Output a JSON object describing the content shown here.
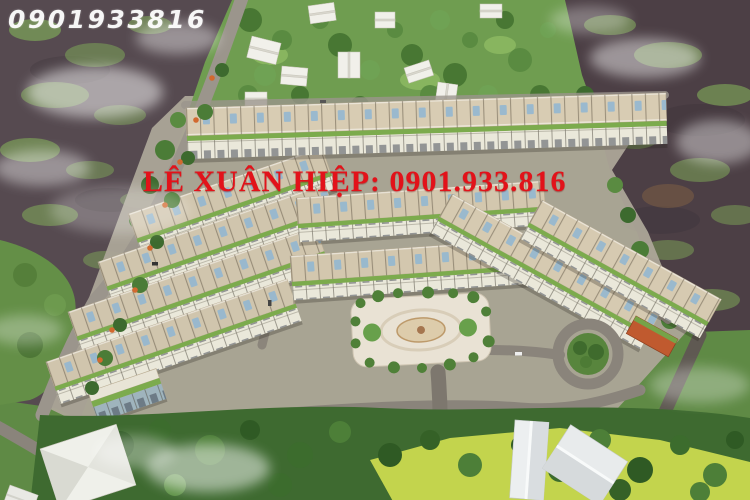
{
  "scene": {
    "kind": "aerial-3d-render",
    "subject": "residential-townhouse-development-with-river-and-trees"
  },
  "watermarks": {
    "top_phone": "0901933816",
    "agent_line": "LÊ XUÂN HIỆP: 0901.933.816"
  },
  "colors": {
    "watermark_white": "#ffffff",
    "watermark_red": "#e2121a",
    "water_dark": "#4c3f45",
    "algae_green": "#7ea558",
    "tree_green": "#487733",
    "roof_beige": "#d6cab1",
    "facade_white": "#eae8da",
    "balcony_green": "#7cab4d",
    "road_gray": "#9a948a",
    "plaza_light": "#e9e2d4",
    "field_yellow_green": "#c3d44d",
    "accent_building_orange": "#c05a2f"
  }
}
